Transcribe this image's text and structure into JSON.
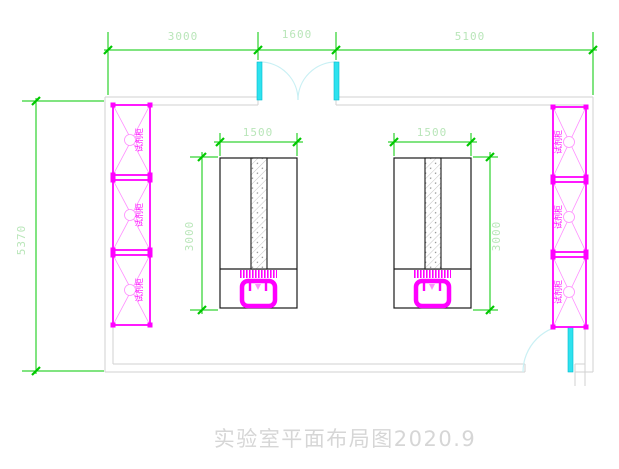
{
  "drawing": {
    "title": "实验室平面布局图2020.9",
    "type_note": "laboratory floor plan"
  },
  "dims": {
    "top_left": "3000",
    "top_middle": "1600",
    "top_right": "5100",
    "room_depth": "5370",
    "bench_left_width": "1500",
    "bench_left_depth": "3000",
    "bench_right_width": "1500",
    "bench_right_depth": "3000"
  },
  "cabinets": {
    "left": [
      {
        "label": "试剂柜"
      },
      {
        "label": "试剂柜"
      },
      {
        "label": "试剂柜"
      }
    ],
    "right": [
      {
        "label": "试剂柜"
      },
      {
        "label": "试剂柜"
      },
      {
        "label": "试剂柜"
      }
    ]
  },
  "colors": {
    "green": "#00c800",
    "dimtext": "#b9e6b9",
    "magenta": "#ff00ff",
    "pink": "#ff8dff",
    "cyan": "#2ee2ee",
    "cyandark": "#00bcd0",
    "cyanpale": "#c9f0f4",
    "wall": "#d2d2d2",
    "ink": "#1a1a1a",
    "faint": "#d6d6d6"
  }
}
